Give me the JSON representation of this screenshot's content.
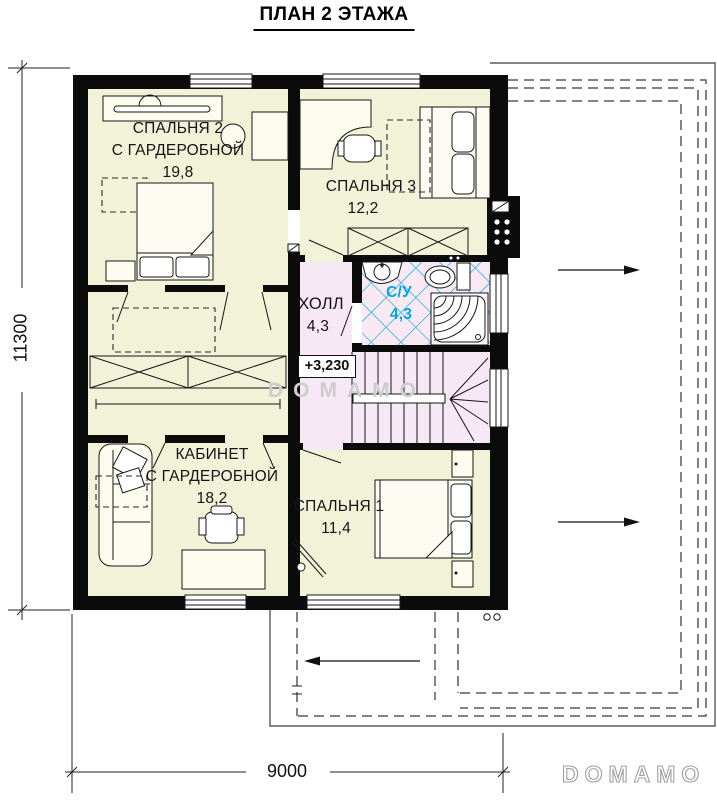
{
  "title": "ПЛАН 2 ЭТАЖА",
  "rooms": {
    "bedroom2": {
      "name": "СПАЛЬНЯ 2",
      "suffix": "С ГАРДЕРОБНОЙ",
      "area": "19,8"
    },
    "bedroom3": {
      "name": "СПАЛЬНЯ 3",
      "area": "12,2"
    },
    "hall": {
      "name": "ХОЛЛ",
      "area": "4,3"
    },
    "bathroom": {
      "name": "С/У",
      "area": "4,3"
    },
    "office": {
      "name": "КАБИНЕТ",
      "suffix": "С ГАРДЕРОБНОЙ",
      "area": "18,2"
    },
    "bedroom1": {
      "name": "СПАЛЬНЯ 1",
      "area": "11,4"
    }
  },
  "elevation_mark": "+3,230",
  "dimensions": {
    "vertical": "11300",
    "horizontal": "9000"
  },
  "watermark": "DOMAMO",
  "brand_logo": "DOMAMO",
  "colors": {
    "wall": "#0b0b0b",
    "room": "#f2f2d9",
    "hall": "#f6e9f5",
    "bath": "#f9e9f3",
    "tile": "#2ab2e5",
    "bath_text": "#00a7e1"
  }
}
